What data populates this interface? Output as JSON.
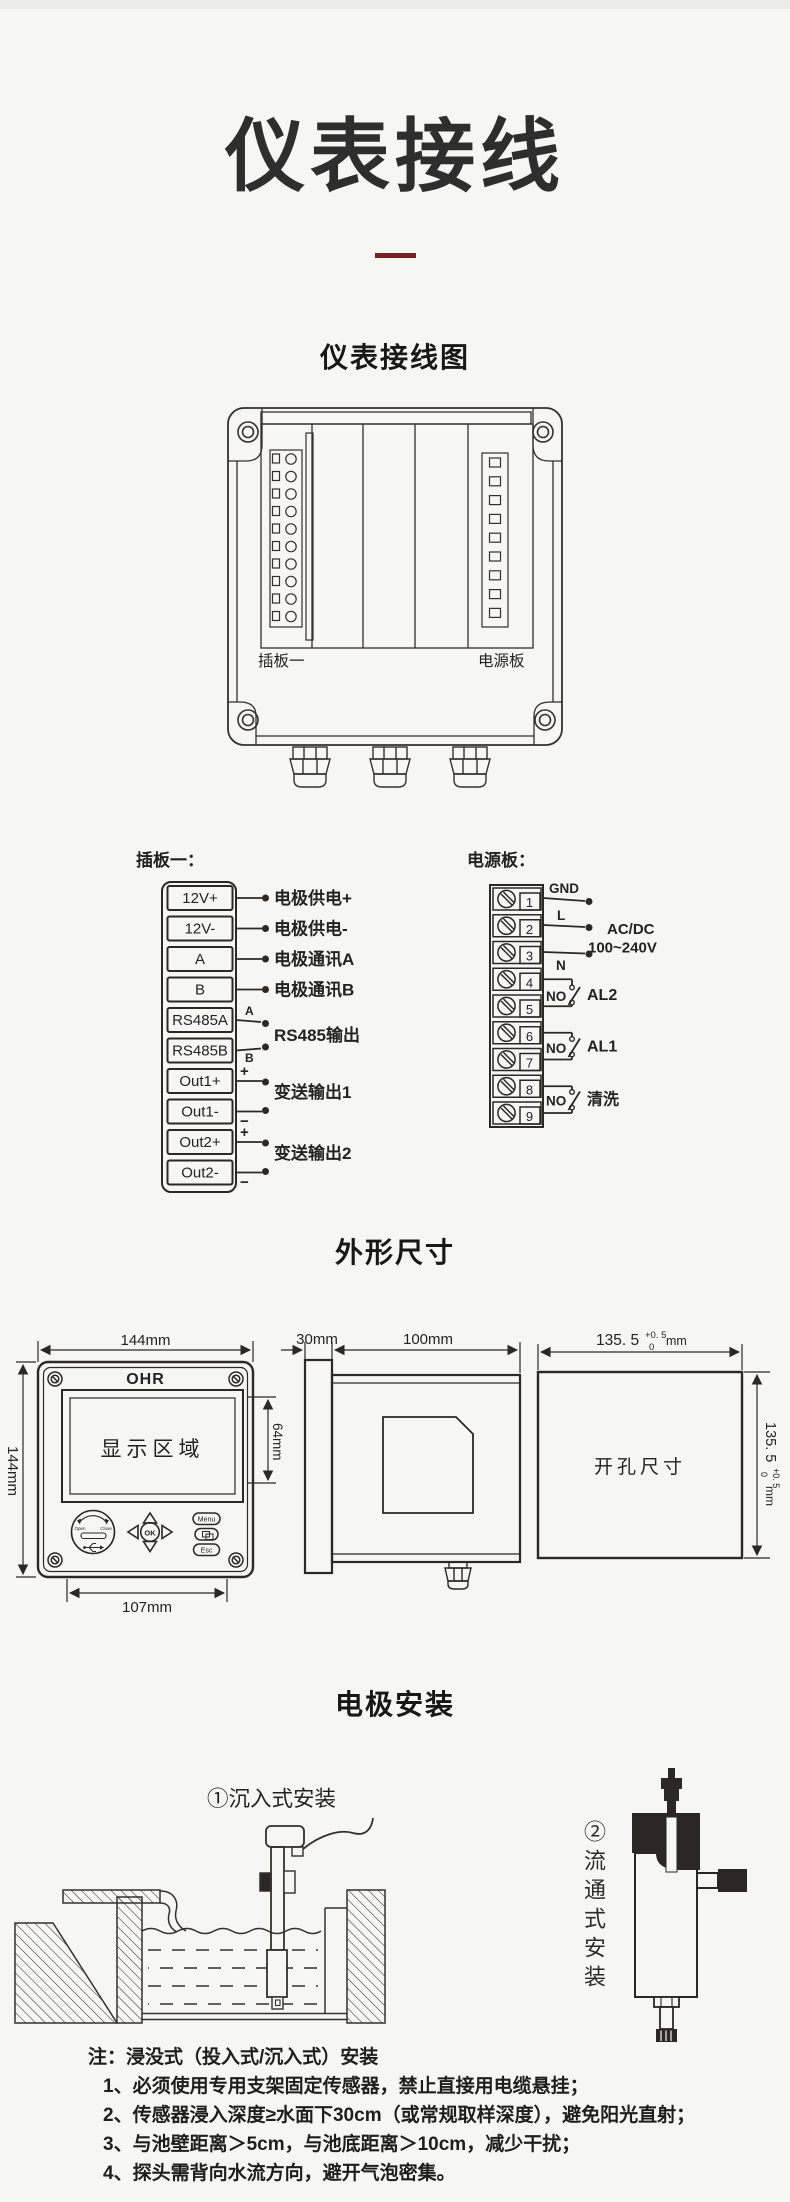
{
  "page": {
    "title": "仪表接线"
  },
  "wiring": {
    "heading": "仪表接线图",
    "slot1_label": "插板一",
    "power_label": "电源板"
  },
  "plugboard": {
    "title": "插板一：",
    "terminals": [
      "12V+",
      "12V-",
      "A",
      "B",
      "RS485A",
      "RS485B",
      "Out1+",
      "Out1-",
      "Out2+",
      "Out2-"
    ],
    "wire_labels": [
      "电极供电+",
      "电极供电-",
      "电极通讯A",
      "电极通讯B"
    ],
    "rs485_a": "A",
    "rs485_b": "B",
    "rs485_label": "RS485输出",
    "out1_label": "变送输出1",
    "out2_label": "变送输出2",
    "plus": "+",
    "minus": "−"
  },
  "powerboard": {
    "title": "电源板：",
    "numbers": [
      "1",
      "2",
      "3",
      "4",
      "5",
      "6",
      "7",
      "8",
      "9"
    ],
    "gnd": "GND",
    "l": "L",
    "n": "N",
    "acdc1": "AC/DC",
    "acdc2": "100~240V",
    "no": "NO",
    "al2": "AL2",
    "al1": "AL1",
    "clean": "清洗"
  },
  "dimensions": {
    "heading": "外形尺寸",
    "front": {
      "brand": "OHR",
      "display": "显示区域",
      "width": "144mm",
      "height": "144mm",
      "disp_h": "64mm",
      "bottom": "107mm",
      "open": "Open",
      "close": "Close",
      "ok": "OK",
      "menu": "Menu",
      "esc": "Esc"
    },
    "side": {
      "bezel": "30mm",
      "depth": "100mm"
    },
    "cutout": {
      "label": "开孔尺寸",
      "main": "135. 5",
      "sup": "+0. 5",
      "sub": "0",
      "unit": "mm"
    }
  },
  "install": {
    "heading": "电极安装",
    "immersion_label": "①沉入式安装",
    "flow_label": "②流通式安装",
    "notes": {
      "title": "注：浸没式（投入式/沉入式）安装",
      "n1": "1、必须使用专用支架固定传感器，禁止直接用电缆悬挂；",
      "n2": "2、传感器浸入深度≥水面下30cm（或常规取样深度），避免阳光直射；",
      "n3": "3、与池壁距离＞5cm，与池底距离＞10cm，减少干扰；",
      "n4": "4、探头需背向水流方向，避开气泡密集。"
    }
  }
}
